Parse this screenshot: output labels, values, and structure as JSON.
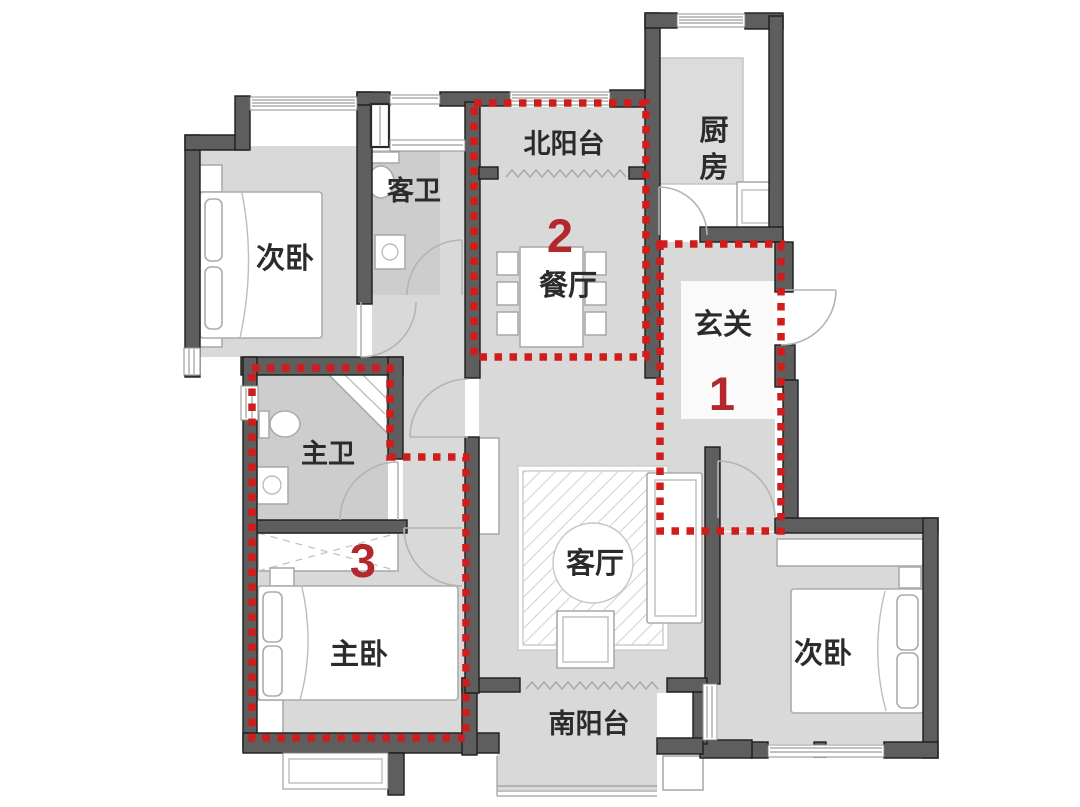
{
  "plan": {
    "rooms": [
      {
        "name": "bedroom-top-left",
        "label": "次卧"
      },
      {
        "name": "guest-bathroom",
        "label": "客卫"
      },
      {
        "name": "north-balcony",
        "label": "北阳台"
      },
      {
        "name": "dining-room",
        "label": "餐厅"
      },
      {
        "name": "kitchen",
        "label": "厨房",
        "label_char1": "厨",
        "label_char2": "房"
      },
      {
        "name": "entry-hall",
        "label": "玄关"
      },
      {
        "name": "living-room",
        "label": "客厅"
      },
      {
        "name": "south-balcony",
        "label": "南阳台"
      },
      {
        "name": "master-bathroom",
        "label": "主卫"
      },
      {
        "name": "master-bedroom",
        "label": "主卧"
      },
      {
        "name": "bedroom-bottom-right",
        "label": "次卧"
      }
    ],
    "zone_markers": [
      {
        "number": "1"
      },
      {
        "number": "2"
      },
      {
        "number": "3"
      }
    ],
    "colors": {
      "wall": "#5e5e5e",
      "floor": "#d9d9d9",
      "bath_floor": "#cdcdcd",
      "zone_outline": "#cf1d1d",
      "zone_number": "#b3282d",
      "label": "#2b2b2b"
    }
  }
}
